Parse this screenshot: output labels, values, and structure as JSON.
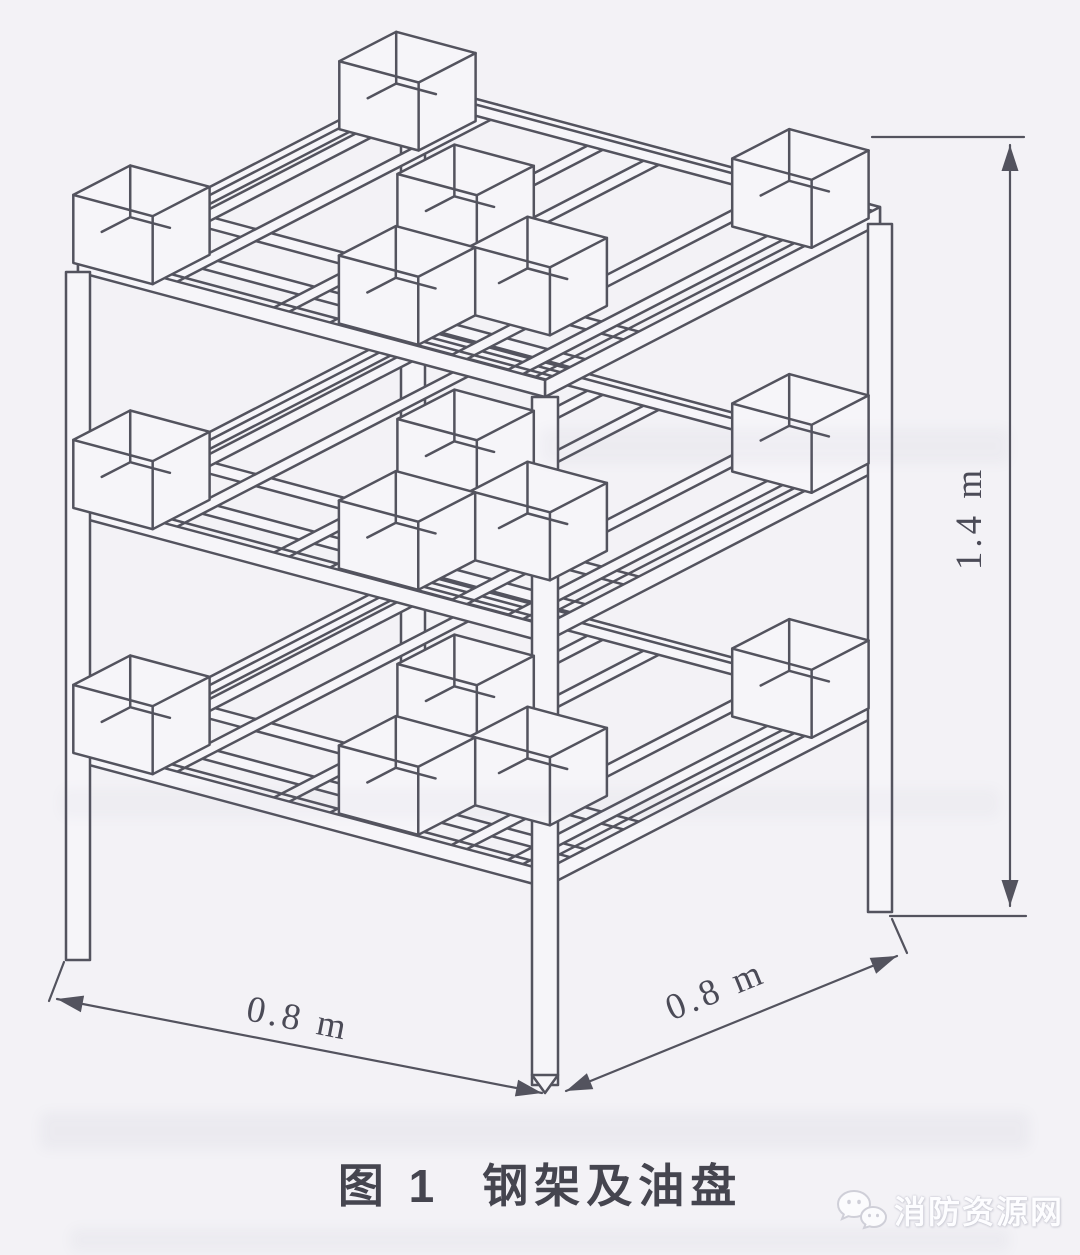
{
  "figure": {
    "label": "图 1",
    "title": "钢架及油盘"
  },
  "dimensions": {
    "width_left": "0.8 m",
    "width_right": "0.8 m",
    "height": "1.4 m"
  },
  "watermark": {
    "text": "消防资源网",
    "icon": "chat-bubbles-icon"
  },
  "colors": {
    "ink": "#53535e",
    "paper": "#f3f2f6",
    "paper_fill": "#f6f5f9",
    "dim_text": "#4b4b57",
    "watermark_text": "#fdfdff",
    "watermark_outline": "#c6c6d0"
  }
}
